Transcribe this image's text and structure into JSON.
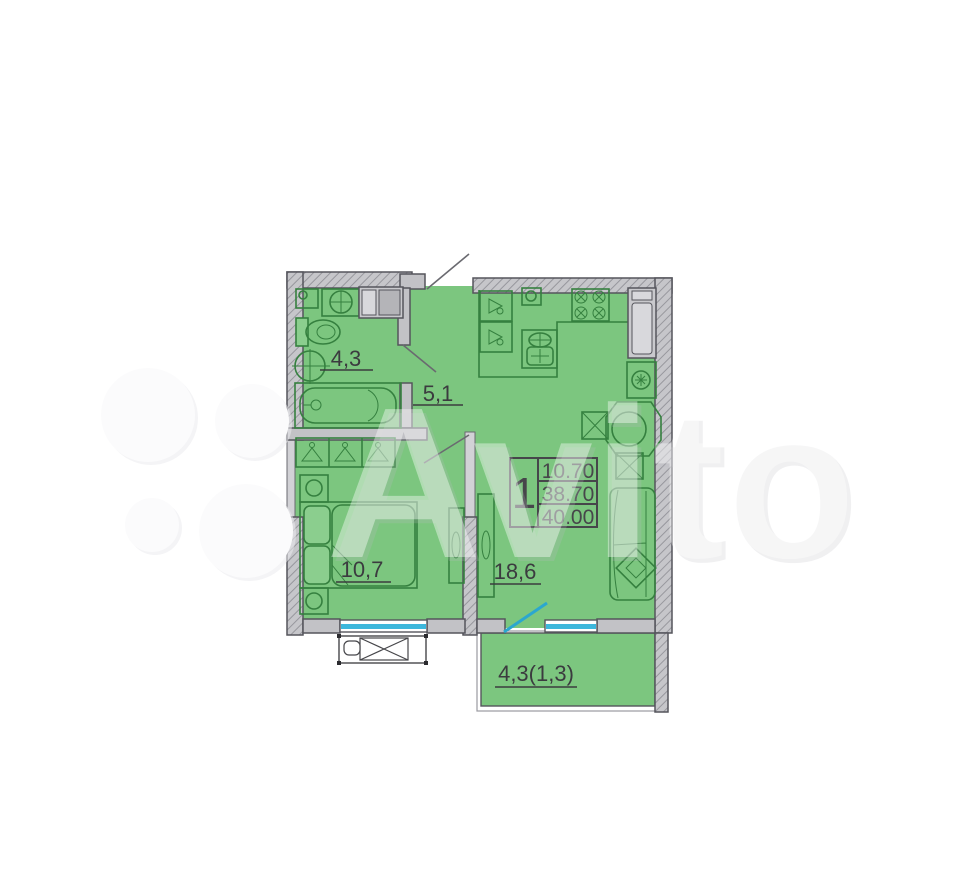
{
  "watermark": {
    "brand": "Avito",
    "logo": "avito-four-circles"
  },
  "legend": {
    "rooms_count": "1",
    "rows": {
      "living_area": "10.70",
      "apartment_area": "38.70",
      "total_area": "40.00"
    }
  },
  "rooms": [
    {
      "id": "bathroom",
      "area_label": "4,3"
    },
    {
      "id": "hallway",
      "area_label": "5,1"
    },
    {
      "id": "bedroom",
      "area_label": "10,7"
    },
    {
      "id": "living-kitchen",
      "area_label": "18,6"
    },
    {
      "id": "balcony",
      "area_label": "4,3(1,3)"
    }
  ],
  "colors": {
    "floor_green": "#7cc67f",
    "furniture_green": "#35803f",
    "wall_gray": "#c2c2c6",
    "wall_outline": "#55555c",
    "window_blue": "#3db7dc",
    "balcony_door_teal": "#2ba7cf",
    "label_text": "#3b3b3f"
  }
}
